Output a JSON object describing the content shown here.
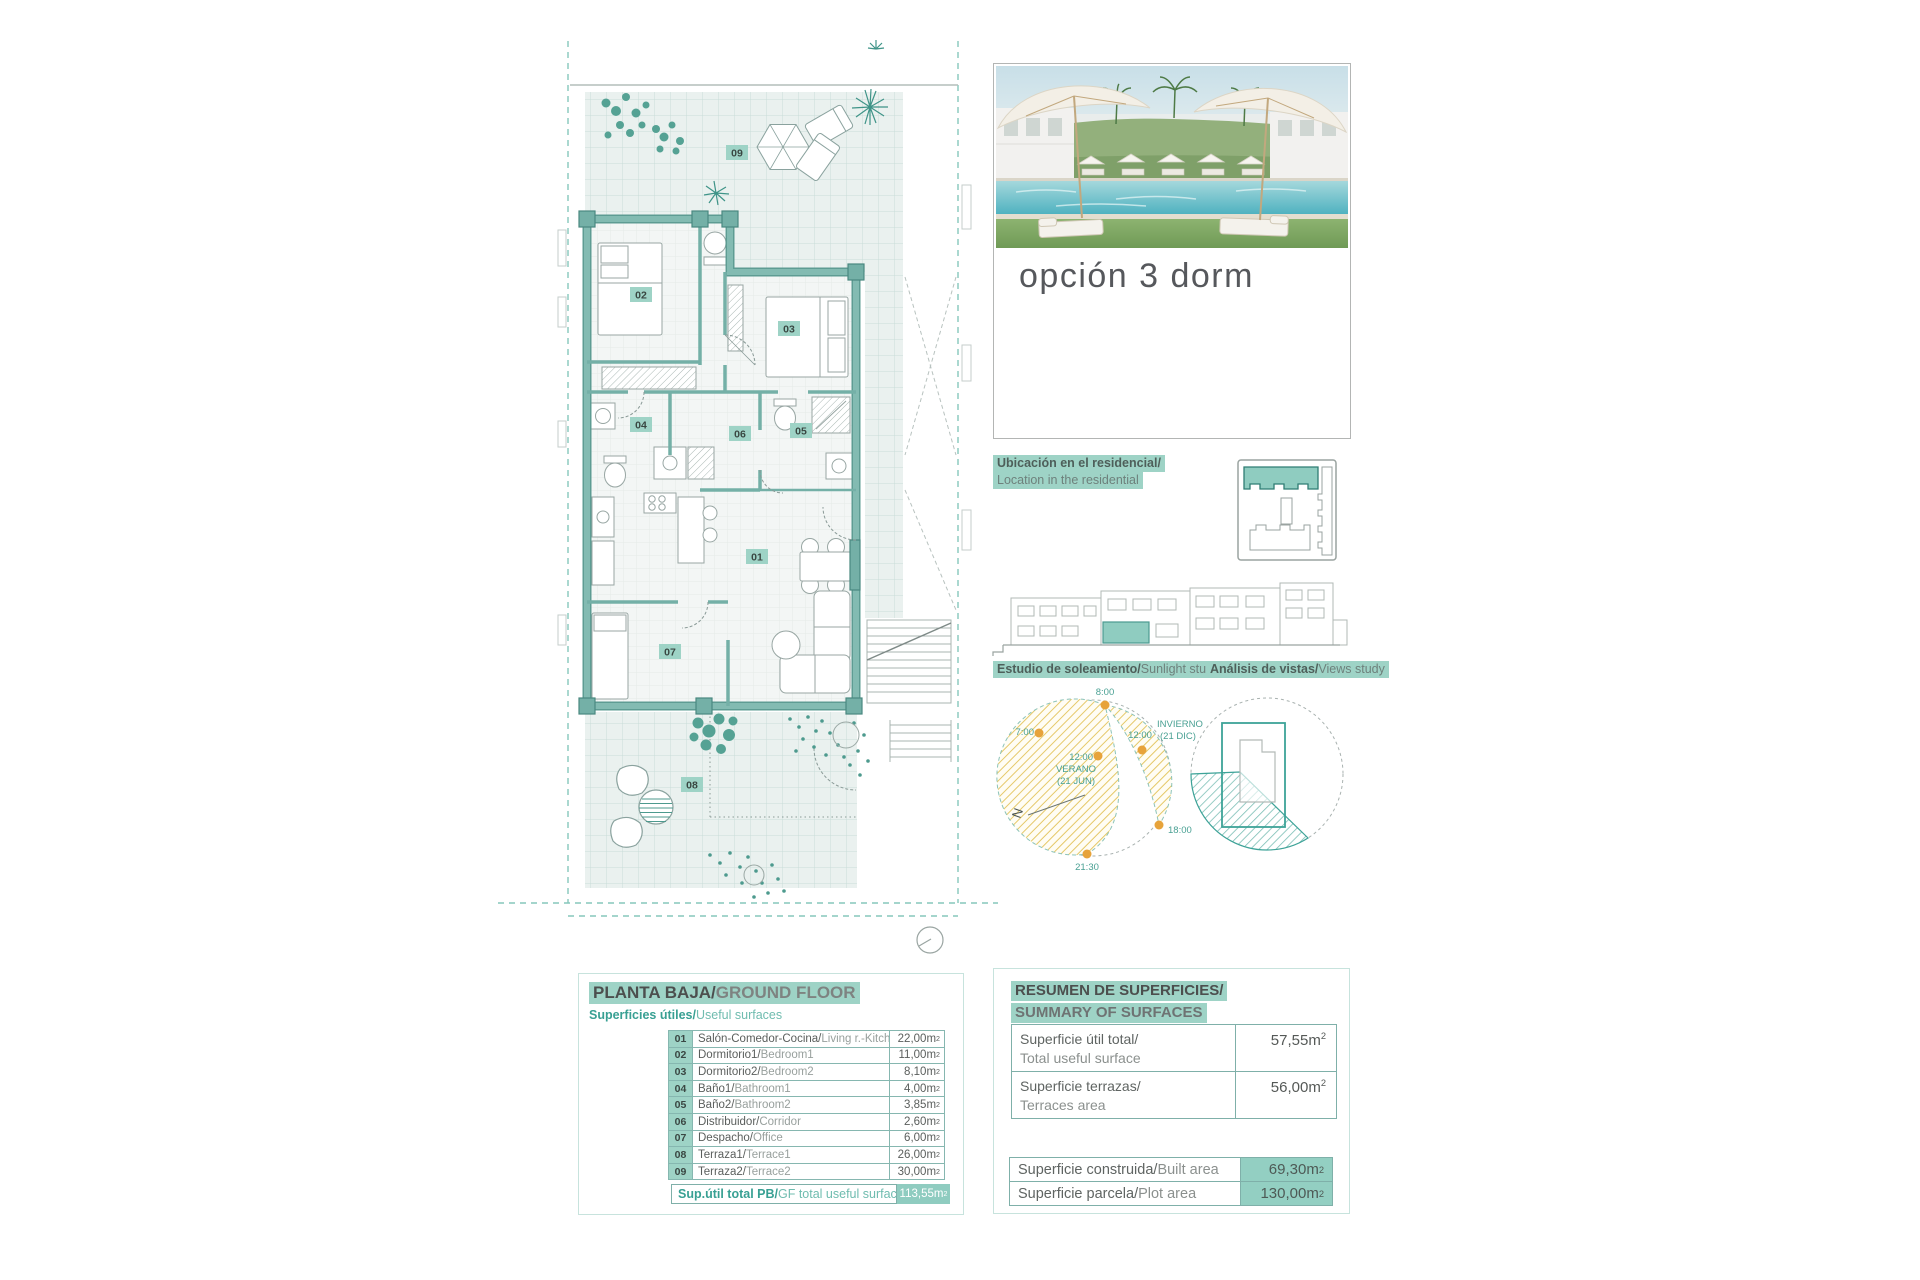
{
  "option": {
    "title": "opción 3 dorm"
  },
  "plan": {
    "room_labels": [
      "01",
      "02",
      "03",
      "04",
      "05",
      "06",
      "07",
      "08",
      "09"
    ]
  },
  "location": {
    "es": "Ubicación en el residencial/",
    "en": "Location in the residential"
  },
  "studies": {
    "sunlight_es": "Estudio de soleamiento/",
    "sunlight_en": "Sunlight study",
    "views_es": "Análisis de vistas/",
    "views_en": "Views study"
  },
  "sun": {
    "t0800": "8:00",
    "t0700": "7:00",
    "t1200_summer": "12:00",
    "t1200_winter": "12:00",
    "t1800": "18:00",
    "t2130": "21:30",
    "verano_l1": "VERANO",
    "verano_l2": "(21 JUN)",
    "invierno_l1": "INVIERNO",
    "invierno_l2": "(21 DIC)",
    "north": "N"
  },
  "unit": {
    "base": "m",
    "sup": "2"
  },
  "left_table": {
    "title_es": "PLANTA BAJA/",
    "title_en": "GROUND FLOOR",
    "subtitle_es": "Superficies útiles/",
    "subtitle_en": "Useful surfaces",
    "rows": [
      {
        "num": "01",
        "es": "Salón-Comedor-Cocina/",
        "en": "Living r.-Kitchen",
        "value": "22,00"
      },
      {
        "num": "02",
        "es": "Dormitorio1/",
        "en": "Bedroom1",
        "value": "11,00"
      },
      {
        "num": "03",
        "es": "Dormitorio2/",
        "en": "Bedroom2",
        "value": "8,10"
      },
      {
        "num": "04",
        "es": "Baño1/",
        "en": "Bathroom1",
        "value": "4,00"
      },
      {
        "num": "05",
        "es": "Baño2/",
        "en": "Bathroom2",
        "value": "3,85"
      },
      {
        "num": "06",
        "es": "Distribuidor/",
        "en": "Corridor",
        "value": "2,60"
      },
      {
        "num": "07",
        "es": "Despacho/",
        "en": "Office",
        "value": "6,00"
      },
      {
        "num": "08",
        "es": "Terraza1/",
        "en": "Terrace1",
        "value": "26,00"
      },
      {
        "num": "09",
        "es": "Terraza2/",
        "en": "Terrace2",
        "value": "30,00"
      }
    ],
    "total_es": "Sup.útil total PB/",
    "total_en": "GF total useful surface",
    "total_value": "113,55"
  },
  "right_table": {
    "title_l1": "RESUMEN DE SUPERFICIES/",
    "title_l2": "SUMMARY OF SURFACES",
    "rows": [
      {
        "es": "Superficie útil total/",
        "en": "Total useful surface",
        "value": "57,55"
      },
      {
        "es": "Superficie terrazas/",
        "en": "Terraces area",
        "value": "56,00"
      }
    ],
    "rows2": [
      {
        "es": "Superficie construida/",
        "en": "Built area",
        "value": "69,30"
      },
      {
        "es": "Superficie parcela/",
        "en": "Plot area",
        "value": "130,00"
      }
    ]
  },
  "colors": {
    "accent_highlight": "#9ed3c6",
    "teal_text": "#38a093",
    "wall_teal": "#74b0a7",
    "sun_dot_orange": "#e7a33b",
    "hatch_yellow": "#e5c868",
    "views_teal": "#3da398"
  }
}
